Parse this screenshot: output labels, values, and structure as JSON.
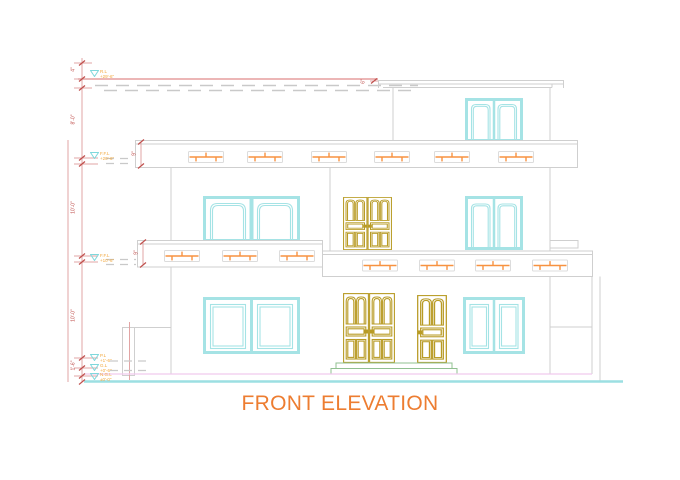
{
  "title": "FRONT ELEVATION",
  "colors": {
    "title_orange": "#ED7D31",
    "vent_orange": "#F79240",
    "window_cyan": "#A5E3E5",
    "door_gold": "#B89B25",
    "wall_gray": "#CFCFCF",
    "dimension_red": "#E2A4A4",
    "tick_red": "#C0504D",
    "plinth_pink": "#F0C9EE",
    "ground_cyan": "#9CDFE2",
    "step_green": "#90C090"
  },
  "levels": [
    {
      "id": "roof",
      "label": "R.L",
      "value": "+29'-6\""
    },
    {
      "id": "terrace",
      "label": "F.F.L",
      "value": "+20'-6\""
    },
    {
      "id": "first-floor",
      "label": "F.F.L",
      "value": "+10'-6\""
    },
    {
      "id": "plinth",
      "label": "P.L",
      "value": "+1'-6\""
    },
    {
      "id": "ground",
      "label": "G.L",
      "value": "+0'-6\""
    },
    {
      "id": "natural-ground",
      "label": "N.G.L",
      "value": "±0'-0\""
    }
  ],
  "dimensions": {
    "parapet": "4\"",
    "upper_floor": "8'-0\"",
    "first_floor": "10'-0\"",
    "ground_floor": "10'-0\"",
    "plinth": "1'-6\"",
    "slab_band": "9\"",
    "mumty_slab": "6\""
  }
}
